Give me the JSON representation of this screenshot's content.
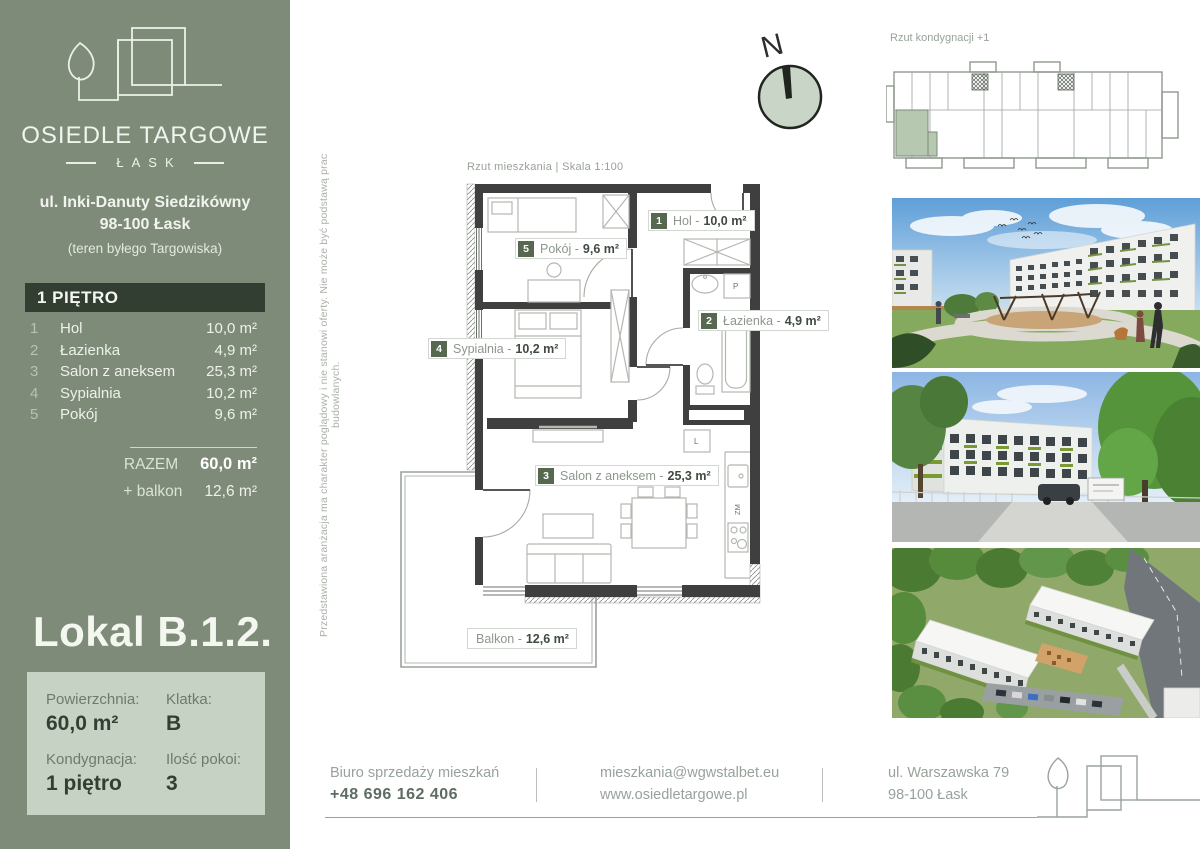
{
  "colors": {
    "sidebar_bg": "#7e8b78",
    "floor_band_bg": "#333e32",
    "info_box_bg": "#c6d2c3",
    "accent_square": "#56684f",
    "compass_fill": "#c9d5c7",
    "highlight_unit": "#b7c8b1",
    "plan_wall": "#3f3f3f",
    "text_light": "#f1f4ee"
  },
  "sidebar": {
    "brand": "OSIEDLE TARGOWE",
    "brand_sub": "ŁASK",
    "address1": "ul. Inki-Danuty Siedzikówny",
    "address2": "98-100 Łask",
    "address3": "(teren byłego Targowiska)",
    "floor_header": "1 PIĘTRO",
    "rooms": [
      {
        "no": "1",
        "name": "Hol",
        "area": "10,0 m²"
      },
      {
        "no": "2",
        "name": "Łazienka",
        "area": "4,9 m²"
      },
      {
        "no": "3",
        "name": "Salon z aneksem",
        "area": "25,3 m²"
      },
      {
        "no": "4",
        "name": "Sypialnia",
        "area": "10,2 m²"
      },
      {
        "no": "5",
        "name": "Pokój",
        "area": "9,6 m²"
      }
    ],
    "total_label": "RAZEM",
    "total_value": "60,0 m²",
    "balcony_label": "+ balkon",
    "balcony_value": "12,6 m²",
    "unit_title": "Lokal B.1.2.",
    "info": {
      "area_label": "Powierzchnia:",
      "area_value": "60,0 m²",
      "staircase_label": "Klatka:",
      "staircase_value": "B",
      "floor_label": "Kondygnacja:",
      "floor_value": "1 piętro",
      "rooms_label": "Ilość pokoi:",
      "rooms_value": "3"
    }
  },
  "plan": {
    "header": "Rzut mieszkania  |  Skala 1:100",
    "compass_n": "N",
    "disclaimer": "Przedstawiona aranżacja ma charakter poglądowy i nie stanowi oferty. Nie może być podstawą prac budowlanych.",
    "labels": {
      "hol": {
        "no": "1",
        "prefix": "Hol -",
        "area": "10,0 m²"
      },
      "lazienka": {
        "no": "2",
        "prefix": "Łazienka -",
        "area": "4,9 m²"
      },
      "salon": {
        "no": "3",
        "prefix": "Salon z aneksem -",
        "area": "25,3 m²"
      },
      "sypialnia": {
        "no": "4",
        "prefix": "Sypialnia -",
        "area": "10,2 m²"
      },
      "pokoj": {
        "no": "5",
        "prefix": "Pokój -",
        "area": "9,6 m²"
      },
      "balkon": {
        "prefix": "Balkon -",
        "area": "12,6 m²"
      }
    },
    "fixtures": {
      "washer": "P",
      "fridge": "L",
      "sink_unit": "ZM"
    }
  },
  "overview": {
    "title": "Rzut kondygnacji +1"
  },
  "footer": {
    "office_label": "Biuro sprzedaży mieszkań",
    "phone": "+48 696 162 406",
    "email": "mieszkania@wgwstalbet.eu",
    "website": "www.osiedletargowe.pl",
    "address1": "ul. Warszawska 79",
    "address2": "98-100 Łask"
  }
}
